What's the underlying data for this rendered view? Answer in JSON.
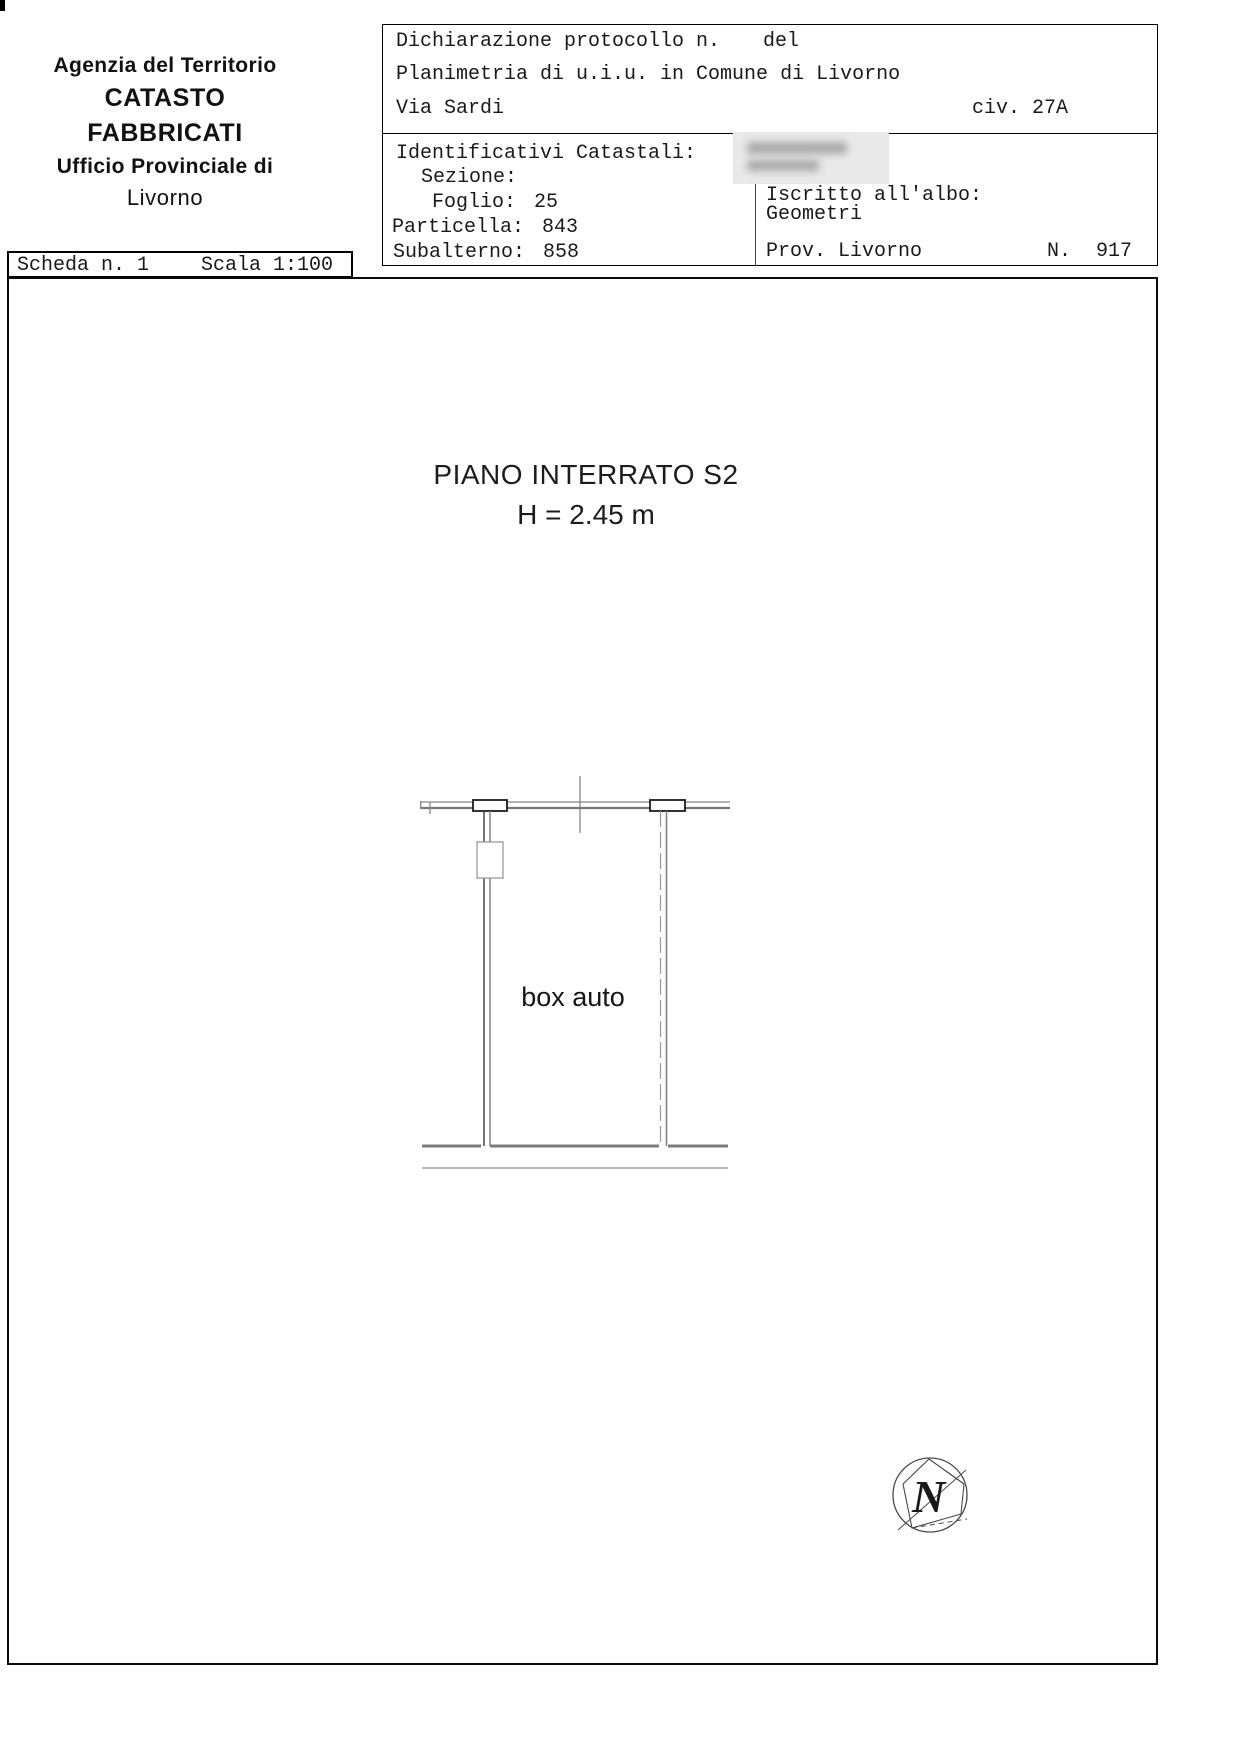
{
  "agency": {
    "line1": "Agenzia del Territorio",
    "line2": "CATASTO FABBRICATI",
    "line3": "Ufficio Provinciale di",
    "line4": "Livorno"
  },
  "declaration": {
    "protocol_label": "Dichiarazione protocollo n.",
    "date_label": "del",
    "planimetria": "Planimetria di u.i.u. in Comune di Livorno",
    "street": "Via Sardi",
    "civic": "civ. 27A"
  },
  "identifiers": {
    "title": "Identificativi Catastali:",
    "sezione_label": "Sezione:",
    "foglio_label": "Foglio:",
    "foglio_value": "25",
    "particella_label": "Particella:",
    "particella_value": "843",
    "subalterno_label": "Subalterno:",
    "subalterno_value": "858"
  },
  "professional": {
    "iscritto_label": "Iscritto all'albo:",
    "albo": "Geometri",
    "prov": "Prov. Livorno",
    "number_label": "N.",
    "number_value": "917"
  },
  "sheet": {
    "scheda": "Scheda n. 1",
    "scala": "Scala 1:100"
  },
  "plan": {
    "floor_title": "PIANO INTERRATO S2",
    "floor_height": "H = 2.45 m",
    "room_label": "box auto",
    "north_label": "N"
  },
  "colors": {
    "wall_gray": "#7d7d7d",
    "wall_light_gray": "#9a9a9a",
    "line_black": "#1a1a1a",
    "frame_black": "#000000"
  }
}
